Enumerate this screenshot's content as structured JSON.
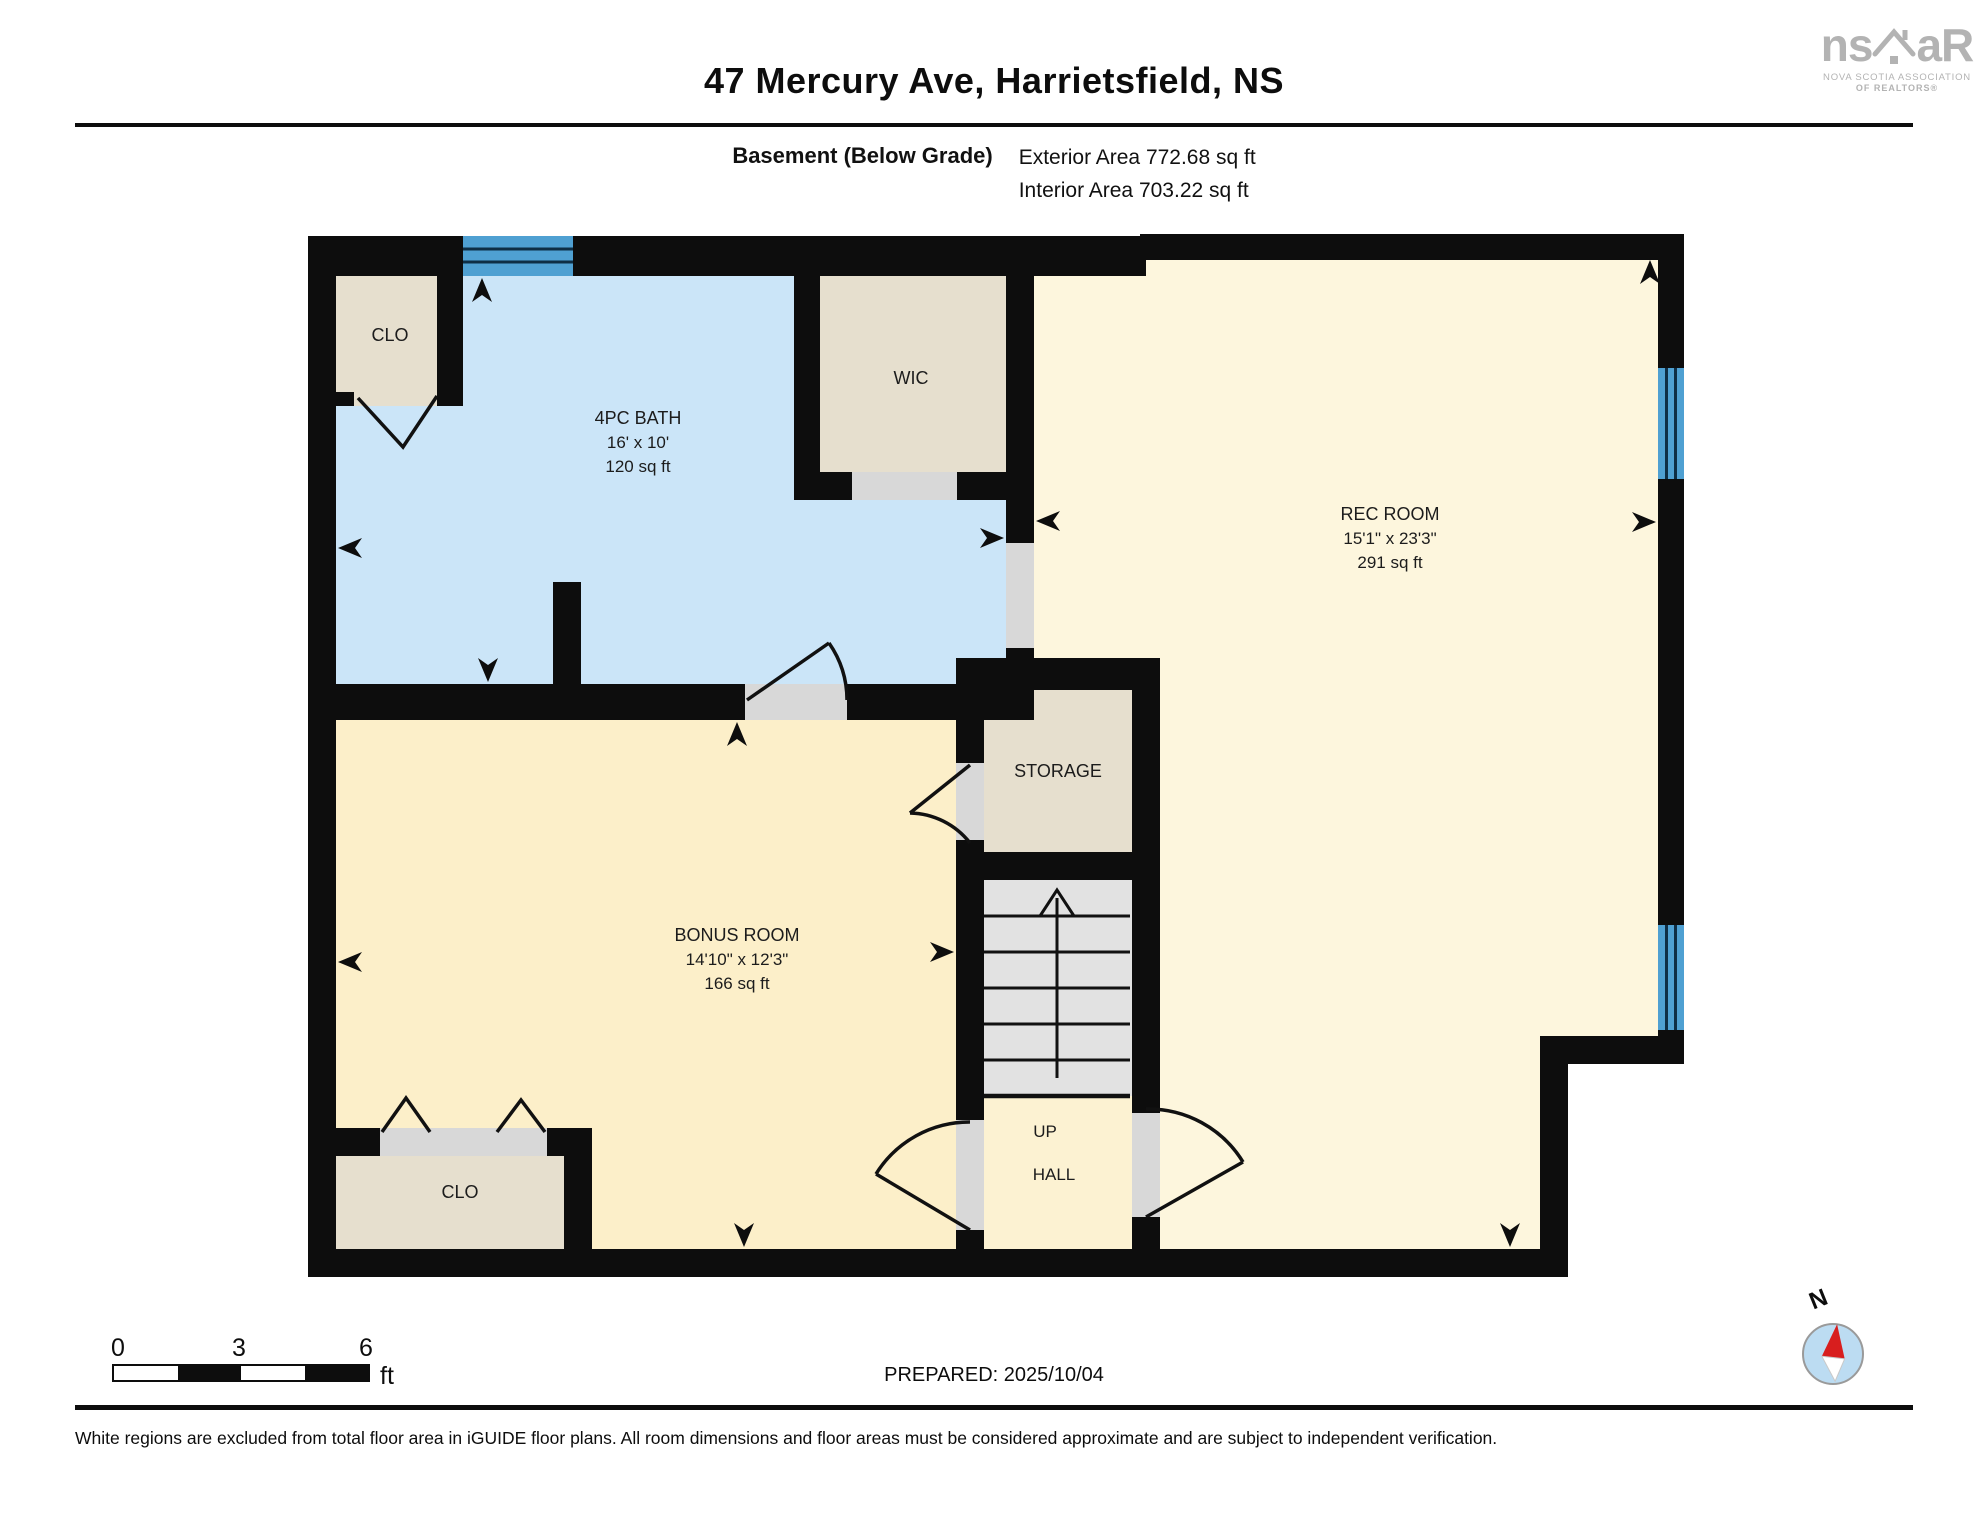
{
  "header": {
    "title": "47 Mercury Ave, Harrietsfield, NS",
    "floor_label": "Basement (Below Grade)",
    "exterior_area": "Exterior Area 772.68 sq ft",
    "interior_area": "Interior Area 703.22 sq ft"
  },
  "logo": {
    "brand_left": "ns",
    "brand_right": "aR",
    "tagline1": "NOVA SCOTIA ASSOCIATION",
    "tagline2": "OF REALTORS®"
  },
  "rooms": {
    "clo_top": {
      "label": "CLO"
    },
    "bath": {
      "label": "4PC BATH",
      "dims": "16' x 10'",
      "area": "120 sq ft"
    },
    "wic": {
      "label": "WIC"
    },
    "rec": {
      "label": "REC ROOM",
      "dims": "15'1\" x 23'3\"",
      "area": "291 sq ft"
    },
    "storage": {
      "label": "STORAGE"
    },
    "bonus": {
      "label": "BONUS ROOM",
      "dims": "14'10\" x 12'3\"",
      "area": "166 sq ft"
    },
    "clo_bottom": {
      "label": "CLO"
    },
    "up": {
      "label": "UP"
    },
    "hall": {
      "label": "HALL"
    }
  },
  "scale_bar": {
    "t0": "0",
    "t3": "3",
    "t6": "6",
    "unit": "ft"
  },
  "compass": {
    "north": "N"
  },
  "footer": {
    "prepared": "PREPARED: 2025/10/04",
    "disclaimer": "White regions are excluded from total floor area in iGUIDE floor plans. All room dimensions and floor areas must be considered approximate and are subject to independent verification."
  },
  "colors": {
    "wall": "#0d0d0d",
    "bath_fill": "#cbe5f8",
    "rec_fill": "#fdf6dd",
    "bonus_fill": "#fcefc9",
    "closet_fill": "#e6dfce",
    "stairs_fill": "#e2e2e2",
    "door_gray": "#d8d8d8",
    "window_blue": "#4fa0d2",
    "compass_red": "#d81e1e",
    "logo_gray": "#b3b3b3"
  }
}
